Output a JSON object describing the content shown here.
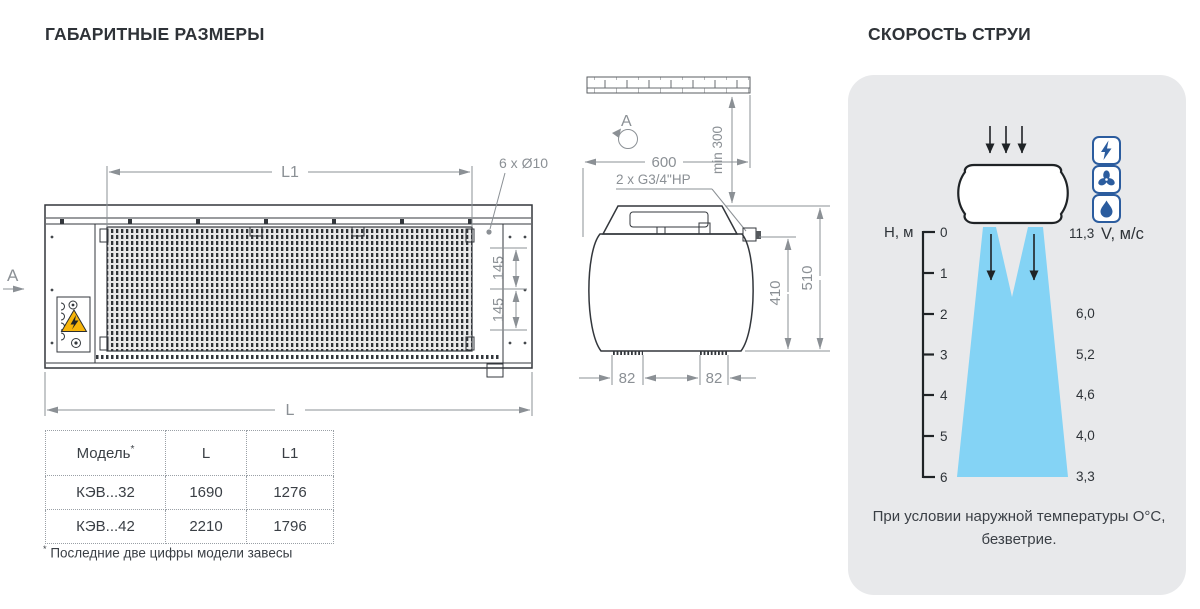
{
  "headings": {
    "left": "ГАБАРИТНЫЕ РАЗМЕРЫ",
    "right": "СКОРОСТЬ СТРУИ"
  },
  "front_view": {
    "view_label": "A",
    "dim_l1": "L1",
    "holes_label": "6 x Ø10",
    "dim_145_upper": "145",
    "dim_145_lower": "145",
    "dim_l": "L"
  },
  "side_view": {
    "view_label": "A",
    "dim_width": "600",
    "dim_ceiling_gap": "min 300",
    "pipe_label": "2 x G3/4\"HP",
    "dim_inner_height": "410",
    "dim_total_height": "510",
    "dim_foot_left": "82",
    "dim_foot_right": "82"
  },
  "table": {
    "headers": [
      "Модель",
      "L",
      "L1"
    ],
    "header_note_mark": "*",
    "rows": [
      [
        "КЭВ...32",
        "1690",
        "1276"
      ],
      [
        "КЭВ...42",
        "2210",
        "1796"
      ]
    ],
    "footnote_mark": "*",
    "footnote_text": " Последние две цифры модели завесы"
  },
  "jet_panel": {
    "height_axis_label": "Н, м",
    "outlet_velocity": "11,3",
    "velocity_axis_label": "V, м/с",
    "scale_ticks": [
      "0",
      "1",
      "2",
      "3",
      "4",
      "5",
      "6"
    ],
    "velocity_values": [
      "6,0",
      "5,2",
      "4,6",
      "4,0",
      "3,3"
    ],
    "caption_line1": "При условии наружной температуры О°С,",
    "caption_line2": "безветрие.",
    "icon_names": [
      "lightning-icon",
      "fan-icon",
      "drop-icon"
    ]
  },
  "colors": {
    "jet_blue": "#84d3f5",
    "icon_blue": "#2b5c9e",
    "warning_yellow": "#f6b40a",
    "panel_bg": "#e8e9eb",
    "dim_gray": "#8b9095",
    "ink": "#33373c"
  },
  "chart_data": {
    "type": "area",
    "title": "Скорость струи",
    "xlabel": "Н, м (высота)",
    "ylabel": "V, м/с (скорость)",
    "x": [
      0,
      2,
      3,
      4,
      5,
      6
    ],
    "values": [
      11.3,
      6.0,
      5.2,
      4.6,
      4.0,
      3.3
    ],
    "note": "При условии наружной температуры О°С, безветрие."
  }
}
